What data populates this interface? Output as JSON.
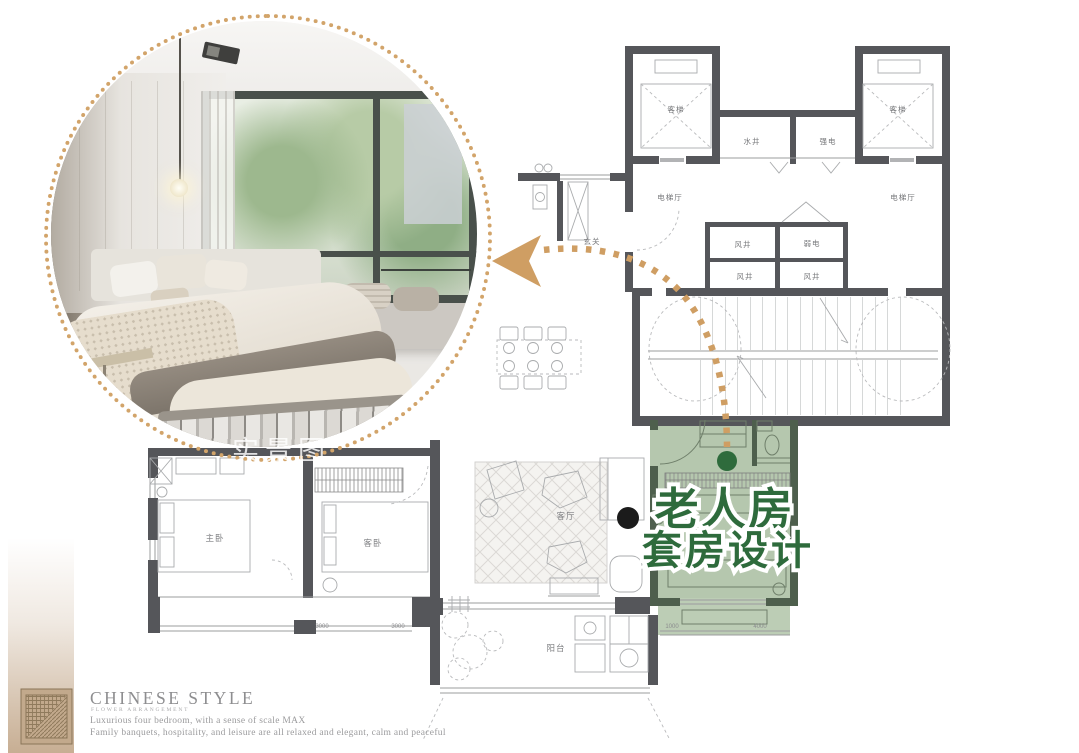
{
  "branding": {
    "title": "CHINESE STYLE",
    "subtitle": "FLOWER ARRANGEMENT",
    "desc1": "Luxurious four bedroom, with a sense of scale MAX",
    "desc2": "Family banquets, hospitality, and leisure are all relaxed and elegant, calm and peaceful"
  },
  "watermark": "实景图",
  "callout": {
    "line1": "老人房",
    "line2": "套房设计"
  },
  "plan": {
    "labels": {
      "elevator_left": "客梯",
      "elevator_right": "客梯",
      "water_shaft": "水井",
      "strong_electric": "强电",
      "weak_electric": "弱电",
      "hall_left": "电梯厅",
      "hall_right": "电梯厅",
      "entry": "玄关",
      "wind_shaft_1": "风井",
      "wind_shaft_2": "风井",
      "wind_shaft_3": "风井",
      "living": "客厅",
      "master": "主卧",
      "guest": "客卧",
      "balcony": "阳台"
    },
    "dimensions": {
      "d1": "3000",
      "d2": "3000",
      "d3": "1000",
      "d4": "4000"
    },
    "colors": {
      "wall": "#55565a",
      "green_fill": "#b5c7ae",
      "green_wall": "#4e5f4d",
      "green_text": "#2e6b3c",
      "trail": "#cf9e63",
      "brand_tan": "#c7ae93"
    }
  }
}
